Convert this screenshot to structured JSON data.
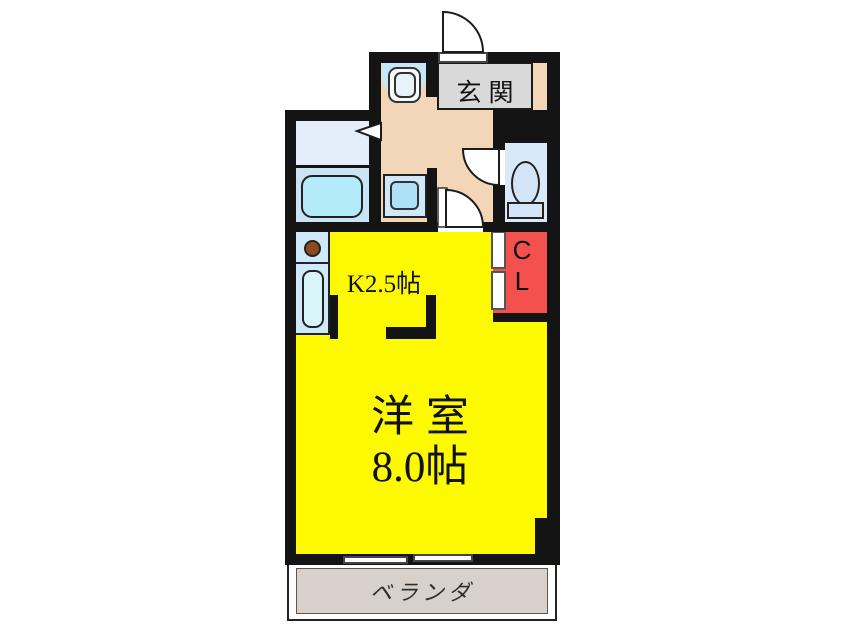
{
  "floorplan": {
    "title": "apartment-floor-plan",
    "rooms": {
      "entrance": {
        "label": "玄関"
      },
      "kitchen": {
        "label": "K2.5帖"
      },
      "main_room": {
        "label_line1": "洋室",
        "label_line2": "8.0帖"
      },
      "closet": {
        "label_line1": "C",
        "label_line2": "L"
      },
      "veranda": {
        "label": "ベランダ"
      },
      "washroom": {
        "label": ""
      },
      "bathroom": {
        "label": ""
      },
      "toilet_room": {
        "label": ""
      }
    },
    "fixtures": [
      "entrance-swing-door",
      "wash-basin",
      "washing-machine",
      "bathtub",
      "toilet",
      "toilet-swing-door",
      "kitchen-swing-door",
      "stove-burner",
      "kitchen-sink",
      "closet-sliding-door",
      "sliding-window",
      "washroom-door-arrow"
    ],
    "colors": {
      "wall": "#141414",
      "hallway_peach": "#f3d6b8",
      "room_yellow": "#fdf900",
      "closet_red": "#f4504e",
      "entrance_gray": "#d9d9d9",
      "veranda_beige": "#d7d1c9",
      "counter_blue": "#cfe9fa",
      "bathroom_blue": "#cbe4f5",
      "washroom_blue": "#e3eefa",
      "toilet_blue": "#d8e9f9",
      "tub_cyan": "#b4ebfa",
      "burner_brown": "#8d4a1f"
    }
  }
}
